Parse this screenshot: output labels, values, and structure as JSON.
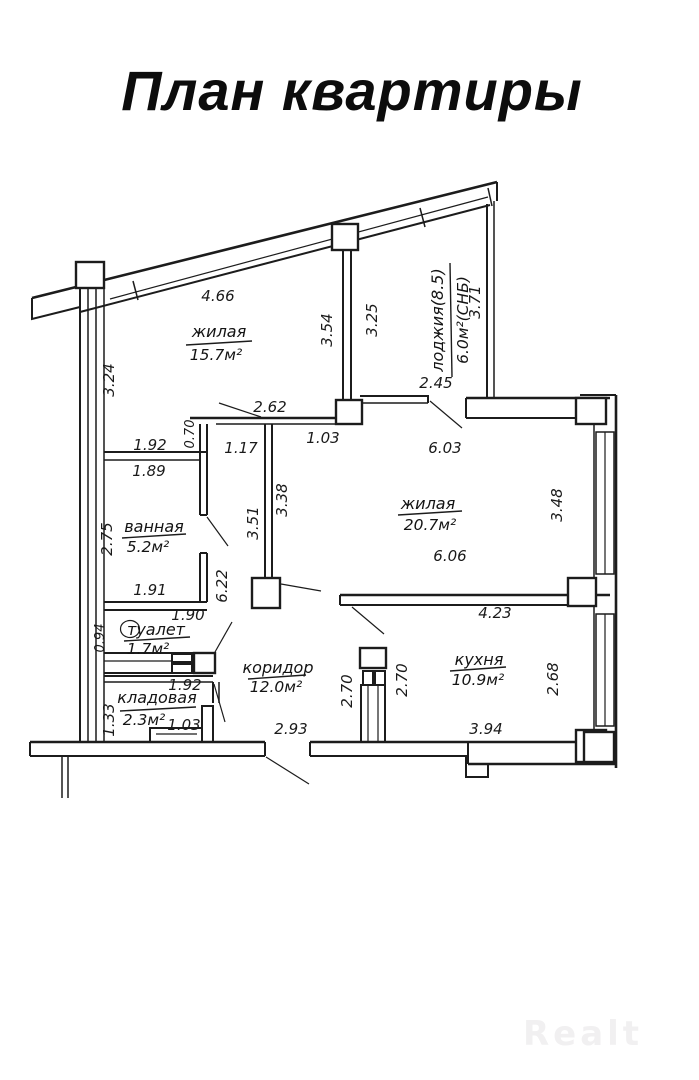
{
  "page": {
    "title": "План квартиры",
    "watermark": "Realt",
    "paper_color": "#ffffff",
    "line_color": "#1c1c1c"
  },
  "rooms": {
    "living1": {
      "name": "жилая",
      "area": "15.7м²"
    },
    "living2": {
      "name": "жилая",
      "area": "20.7м²"
    },
    "loggia": {
      "name": "лоджия(8.5)",
      "area": "6.0м²(СНБ)"
    },
    "bathroom": {
      "name": "ванная",
      "area": "5.2м²"
    },
    "toilet": {
      "name": "туалет",
      "area": "1.7м²"
    },
    "storage": {
      "name": "кладовая",
      "area": "2.3м²"
    },
    "corridor": {
      "name": "коридор",
      "area": "12.0м²"
    },
    "kitchen": {
      "name": "кухня",
      "area": "10.9м²"
    }
  },
  "dims": [
    "4.66",
    "3.24",
    "3.54",
    "3.25",
    "3.71",
    "2.45",
    "2.62",
    "1.92",
    "0.70",
    "1.17",
    "1.03",
    "6.03",
    "1.89",
    "2.75",
    "3.51",
    "3.38",
    "3.48",
    "6.06",
    "6.22",
    "1.91",
    "1.90",
    "0.94",
    "1.92",
    "1.33",
    "1.03",
    "2.93",
    "2.70",
    "2.70",
    "4.23",
    "2.68",
    "3.94"
  ]
}
